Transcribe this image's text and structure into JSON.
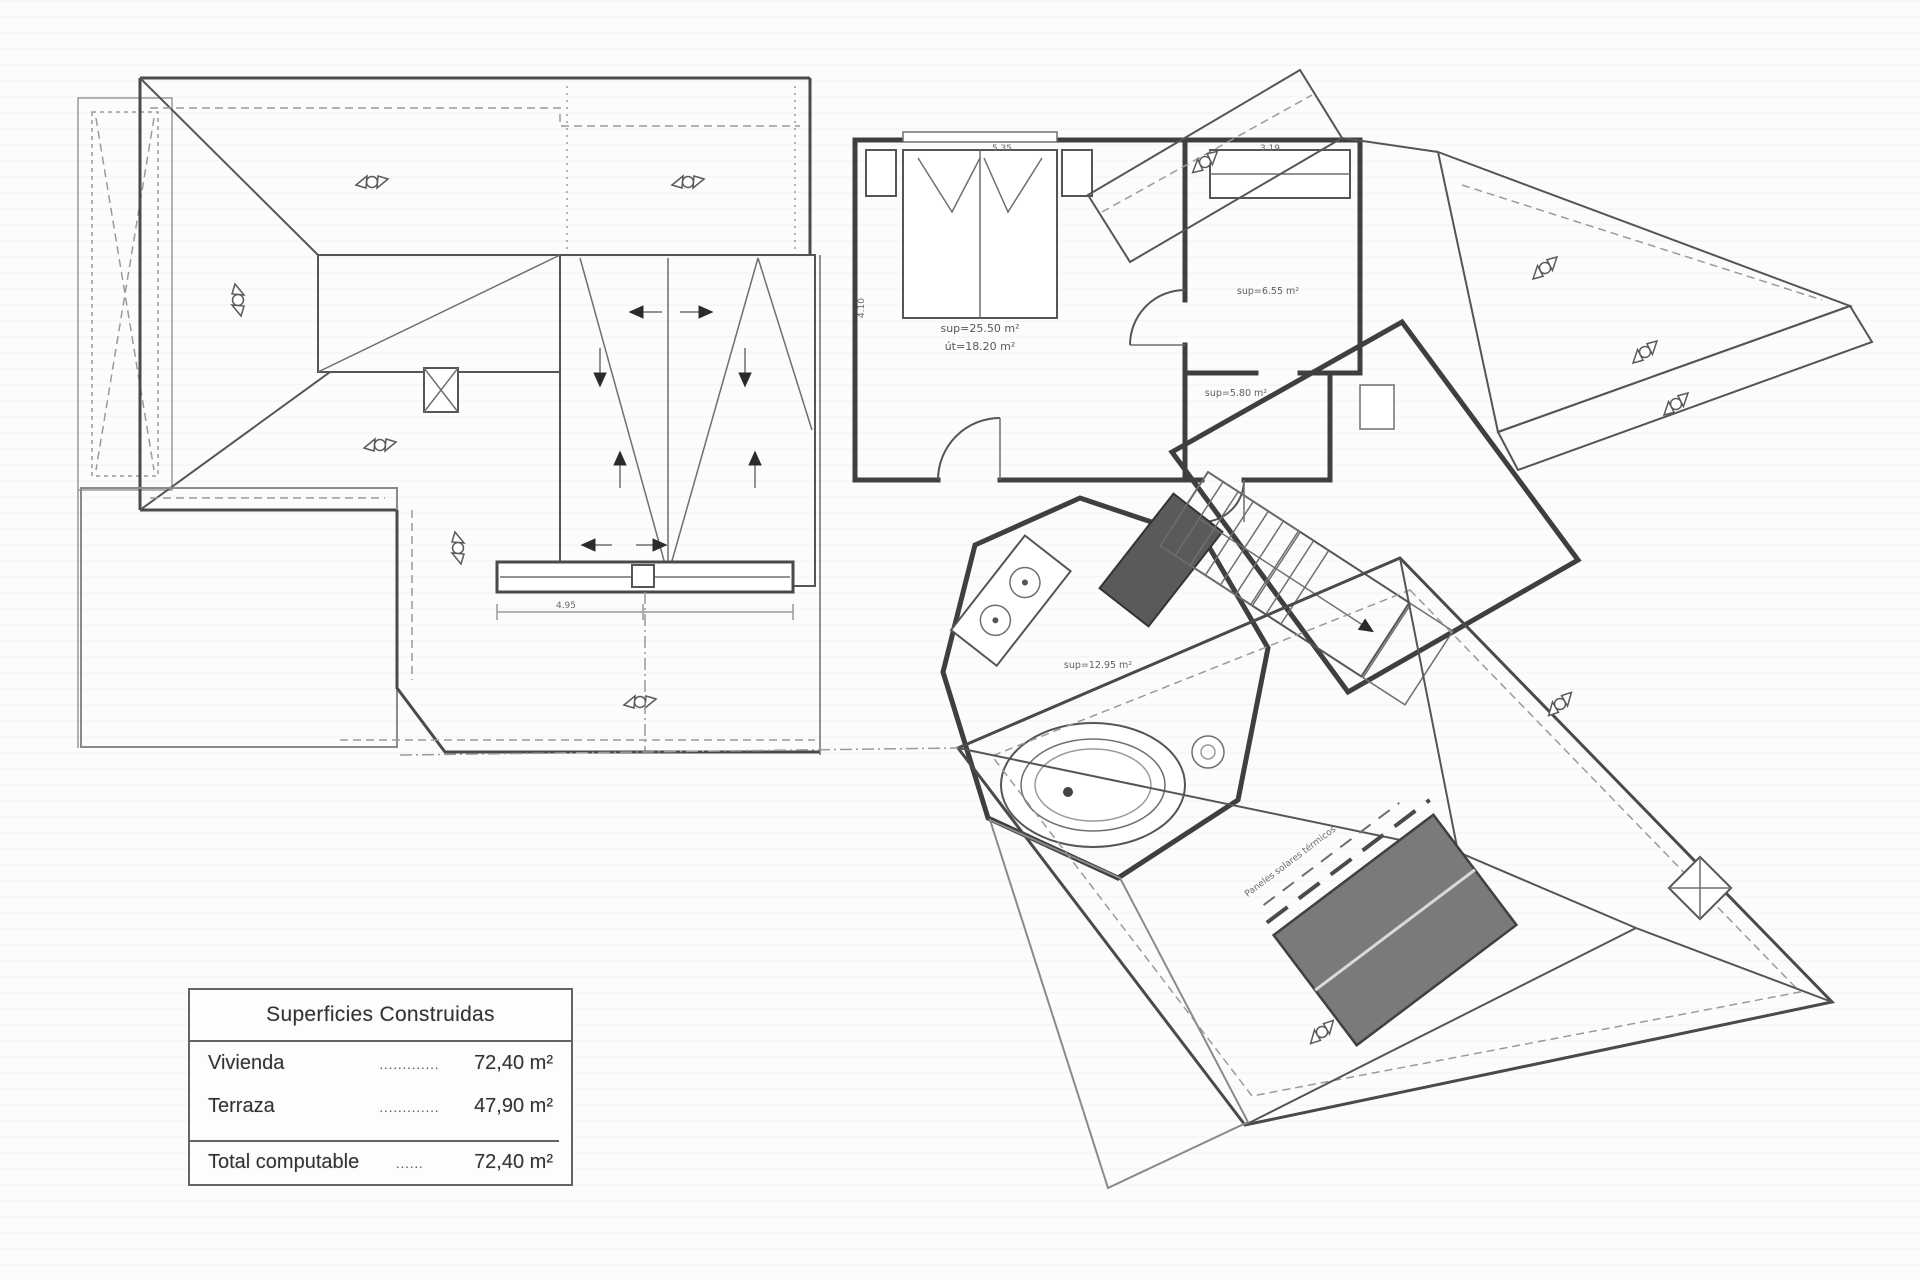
{
  "plan": {
    "rooms": {
      "bedroom": {
        "line1": "sup=25.50 m²",
        "line2": "út=18.20 m²"
      },
      "dressing": "sup=6.55 m²",
      "hall": "sup=5.80 m²",
      "bathroom": "sup=12.95 m²"
    },
    "dimensions": {
      "bedroom_width": "5.35",
      "dressing_width": "3.19",
      "bedroom_depth": "4.10",
      "terrace_width": "4.95"
    },
    "annotations": {
      "solar_panels": "Paneles solares térmicos"
    }
  },
  "legend": {
    "title": "Superficies Construidas",
    "rows": [
      {
        "label": "Vivienda",
        "leader": ".............",
        "value": "72,40 m²"
      },
      {
        "label": "Terraza",
        "leader": ".............",
        "value": "47,90 m²"
      }
    ],
    "total": {
      "label": "Total computable",
      "leader": "......",
      "value": "72,40 m²"
    }
  },
  "colors": {
    "line": "#4a4a4a",
    "light_line": "#9a9a9a",
    "grid": "#bdbdbd",
    "solar_panel": "#7a7a7a",
    "ink": "#333333",
    "paper": "#fcfcfc"
  }
}
